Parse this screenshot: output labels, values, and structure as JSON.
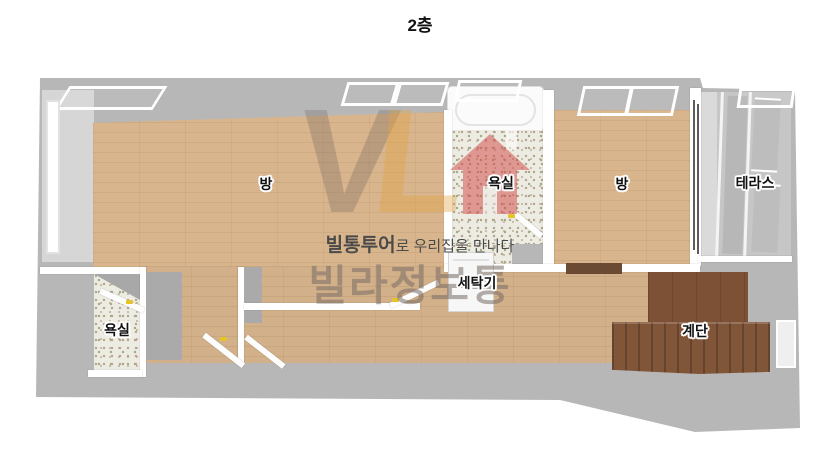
{
  "title": "2층",
  "labels": {
    "room_left": "방",
    "bath_top": "욕실",
    "room_right": "방",
    "terrace": "테라스",
    "washer": "세탁기",
    "bath_bottom": "욕실",
    "stairs": "계단"
  },
  "watermark": {
    "monogram_v": "V",
    "monogram_l": "L",
    "tagline_brand": "빌통투어",
    "tagline_rest": "로 우리집을 만나다",
    "brand": "빌라정보통"
  },
  "colors": {
    "wood_floor": "#d8b58d",
    "tile_floor": "#edece3",
    "wall_gray": "#b7b7b7",
    "stair_brown": "#7d5136",
    "watermark_red": "#d44a4a",
    "watermark_gray": "#877d76",
    "handle_yellow": "#e6c428"
  }
}
